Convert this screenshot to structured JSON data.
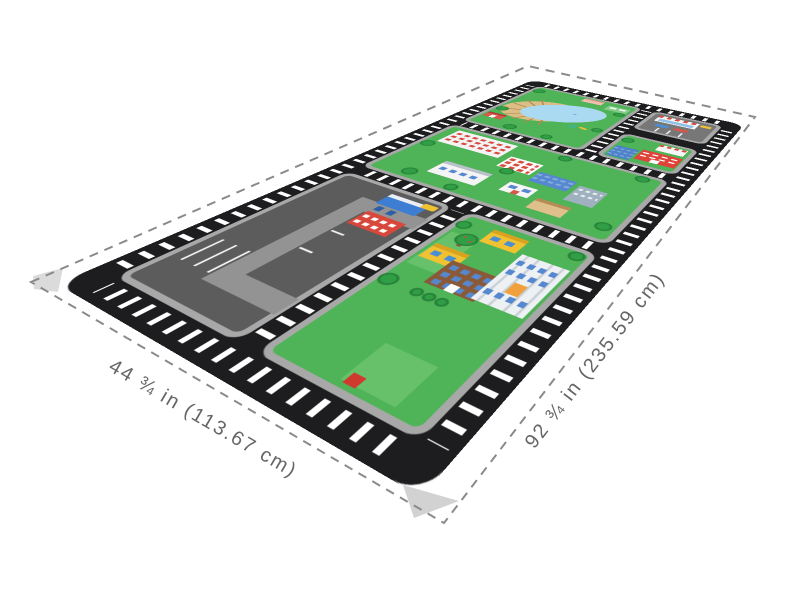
{
  "image": {
    "type": "product-dimension-diagram",
    "subject": "kids city road play mat rendered in perspective on white background"
  },
  "dimensions": {
    "width": {
      "label": "44 ¾ in (113.67 cm)"
    },
    "length": {
      "label": "92 ¾ in (235.59 cm)"
    }
  },
  "style": {
    "dash_color": "#8a8a8a",
    "label_color": "#666666",
    "mat_black": "#1d1d1f",
    "grass_green": "#4fb357",
    "sidewalk_gray": "#a8a8a8",
    "asphalt_gray": "#5c5c5c",
    "lake_blue": "#a9daf2",
    "stripe_white": "#ffffff"
  },
  "mat": {
    "areas": [
      {
        "name": "pond-park-block"
      },
      {
        "name": "corner-shop-parking-block"
      },
      {
        "name": "fire-station-downtown-block"
      },
      {
        "name": "town-center-block"
      },
      {
        "name": "parking-lot-gas-station-block"
      },
      {
        "name": "school-park-block"
      }
    ]
  }
}
